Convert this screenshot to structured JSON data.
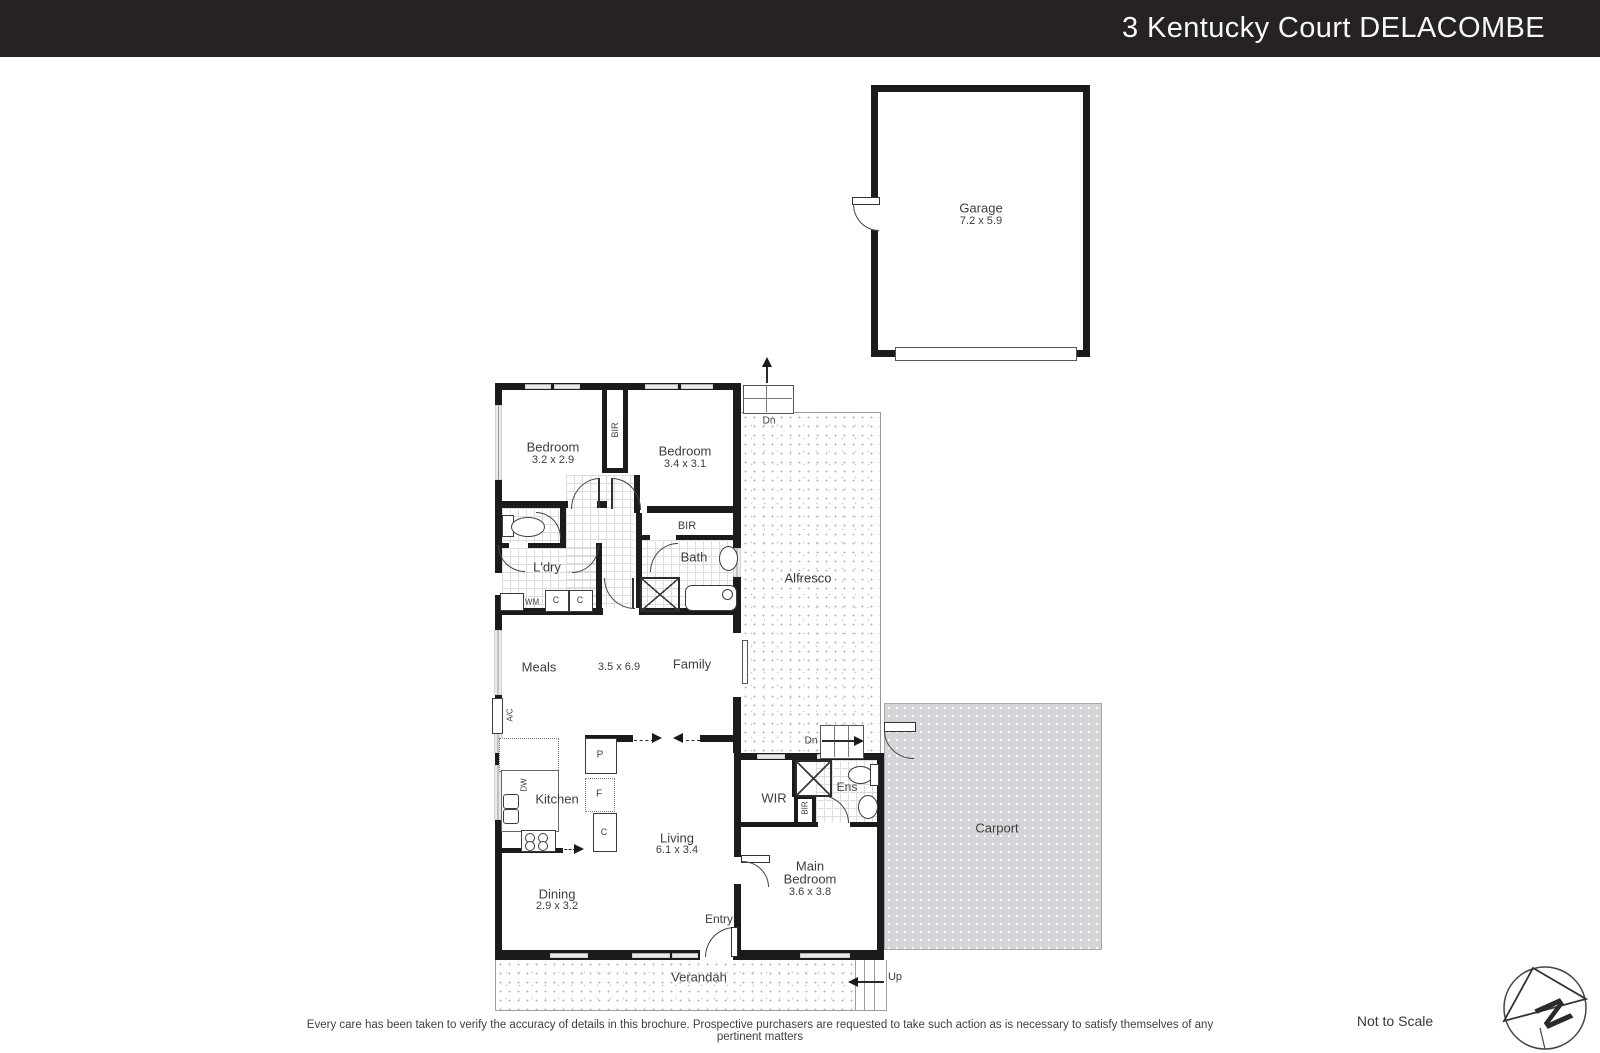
{
  "header": {
    "title": "3 Kentucky Court DELACOMBE"
  },
  "rooms": {
    "garage": {
      "name": "Garage",
      "dims": "7.2 x 5.9"
    },
    "bedroom1": {
      "name": "Bedroom",
      "dims": "3.2 x 2.9"
    },
    "bedroom2": {
      "name": "Bedroom",
      "dims": "3.4 x 3.1"
    },
    "laundry": {
      "name": "L'dry"
    },
    "bath": {
      "name": "Bath"
    },
    "meals": {
      "name": "Meals"
    },
    "family": {
      "name": "Family"
    },
    "meals_family_dims": "3.5 x 6.9",
    "alfresco": {
      "name": "Alfresco"
    },
    "kitchen": {
      "name": "Kitchen"
    },
    "living": {
      "name": "Living",
      "dims": "6.1 x 3.4"
    },
    "dining": {
      "name": "Dining",
      "dims": "2.9 x 3.2"
    },
    "entry": {
      "name": "Entry"
    },
    "wir": {
      "name": "WIR"
    },
    "ens": {
      "name": "Ens"
    },
    "main_bedroom": {
      "name_line1": "Main",
      "name_line2": "Bedroom",
      "dims": "3.6 x 3.8"
    },
    "carport": {
      "name": "Carport"
    },
    "verandah": {
      "name": "Verandah"
    }
  },
  "markers": {
    "bir": "BIR",
    "wm": "WM",
    "cupboard": "C",
    "pantry": "P",
    "fridge": "F",
    "dishwasher": "DW",
    "ac": "A/C",
    "down": "Dn",
    "up": "Up"
  },
  "footer": {
    "disclaimer": "Every care has been taken to verify the accuracy of details in this brochure. Prospective purchasers are requested to take such action as is necessary to satisfy themselves of any pertinent matters",
    "scale_note": "Not to Scale"
  },
  "compass": {
    "letter": "N"
  },
  "colors": {
    "header_bg": "#262223",
    "wall": "#1b1b1b",
    "carport_bg": "#d3d5d8",
    "label_text": "#3d3d3d"
  }
}
